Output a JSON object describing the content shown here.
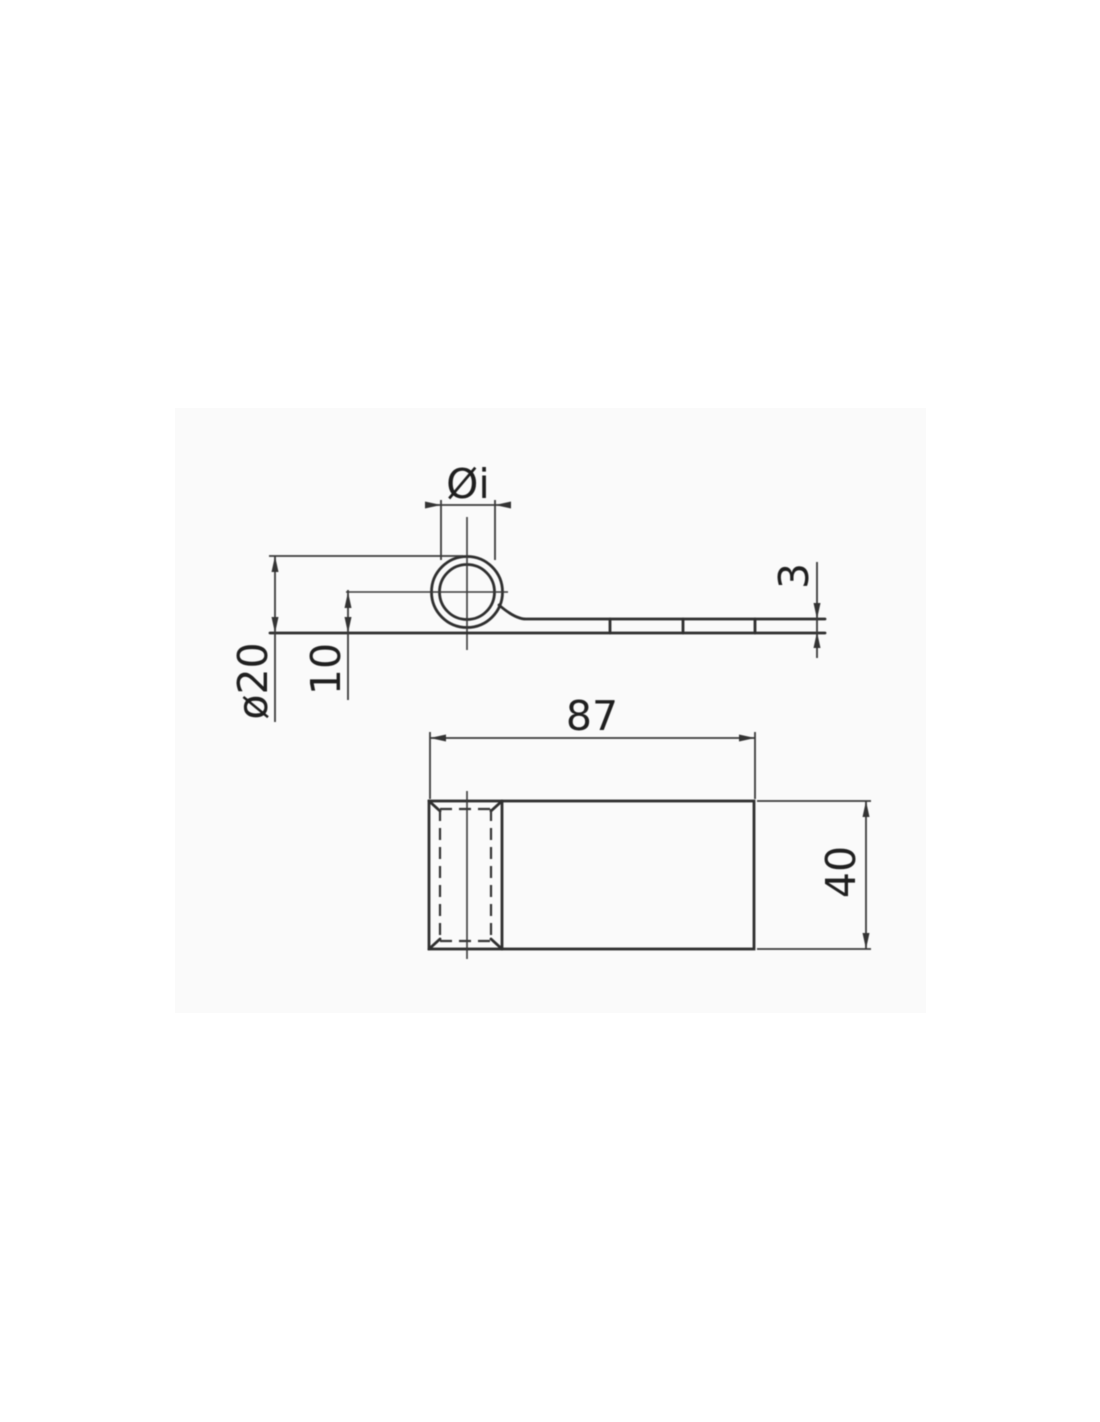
{
  "drawing": {
    "colors": {
      "line": "#333333",
      "background": "#ffffff",
      "panel": "#fafafa"
    },
    "side_view": {
      "dim_inner_diameter": "Øi",
      "dim_outer_diameter": "ø20",
      "dim_center_height": "10",
      "dim_thickness": "3"
    },
    "plan_view": {
      "dim_length": "87",
      "dim_width": "40"
    }
  }
}
